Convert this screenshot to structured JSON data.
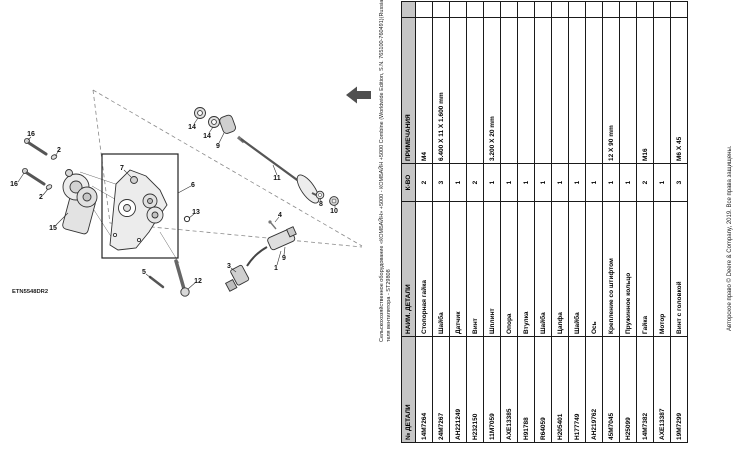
{
  "breadcrumb": {
    "line1": "Сельскохозяйственное оборудование «КОМБАЙН» +5000 - КОМБАЙН +5000 Combine (Worldwide Edition, S.N. 765100-760491)(Russian) (PC10718) +40 Электрооборудование «Мотор двига",
    "line2": "теля вентилятора - ST29808"
  },
  "diagram": {
    "code": "ETN5548DR2",
    "callouts": {
      "c1": "1",
      "c2a": "2",
      "c2b": "2",
      "c3": "3",
      "c4": "4",
      "c5": "5",
      "c6": "6",
      "c7": "7",
      "c8": "8",
      "c9a": "9",
      "c9b": "9",
      "c10": "10",
      "c11": "11",
      "c12": "12",
      "c13": "13",
      "c14a": "14",
      "c14b": "14",
      "c15": "15",
      "c16a": "16",
      "c16b": "16"
    }
  },
  "table": {
    "headers": [
      "№ ДЕТАЛИ",
      "НАИМ. ДЕТАЛИ",
      "К-ВО",
      "ПРИМЕЧАНИЯ"
    ],
    "rows": [
      {
        "part": "14M7264",
        "name": "Стопорная гайка",
        "qty": "2",
        "notes": "M4"
      },
      {
        "part": "24M7267",
        "name": "Шайба",
        "qty": "3",
        "notes": "6.400 X 11 X 1.600 mm"
      },
      {
        "part": "AH221249",
        "name": "Датчик",
        "qty": "1",
        "notes": ""
      },
      {
        "part": "H232150",
        "name": "Винт",
        "qty": "2",
        "notes": ""
      },
      {
        "part": "11M7059",
        "name": "Шплинт",
        "qty": "1",
        "notes": "3.200 X 20 mm"
      },
      {
        "part": "AXE13385",
        "name": "Опора",
        "qty": "1",
        "notes": ""
      },
      {
        "part": "H91788",
        "name": "Втулка",
        "qty": "1",
        "notes": ""
      },
      {
        "part": "R64059",
        "name": "Шайба",
        "qty": "1",
        "notes": ""
      },
      {
        "part": "H205401",
        "name": "Цапфа",
        "qty": "1",
        "notes": ""
      },
      {
        "part": "H177749",
        "name": "Шайба",
        "qty": "1",
        "notes": ""
      },
      {
        "part": "AH219762",
        "name": "Ось",
        "qty": "1",
        "notes": ""
      },
      {
        "part": "45M7045",
        "name": "Крепление со штифтом",
        "qty": "1",
        "notes": "12 X 90 mm"
      },
      {
        "part": "H25099",
        "name": "Пружинное кольцо",
        "qty": "1",
        "notes": ""
      },
      {
        "part": "14M7382",
        "name": "Гайка",
        "qty": "2",
        "notes": "M16"
      },
      {
        "part": "AXE13387",
        "name": "Мотор",
        "qty": "1",
        "notes": ""
      },
      {
        "part": "19M7299",
        "name": "Винт с головкой",
        "qty": "3",
        "notes": "M6 X 45"
      }
    ]
  },
  "footer": {
    "copyright": "Авторское право © Deere & Company, 2019. Все права защищены."
  }
}
